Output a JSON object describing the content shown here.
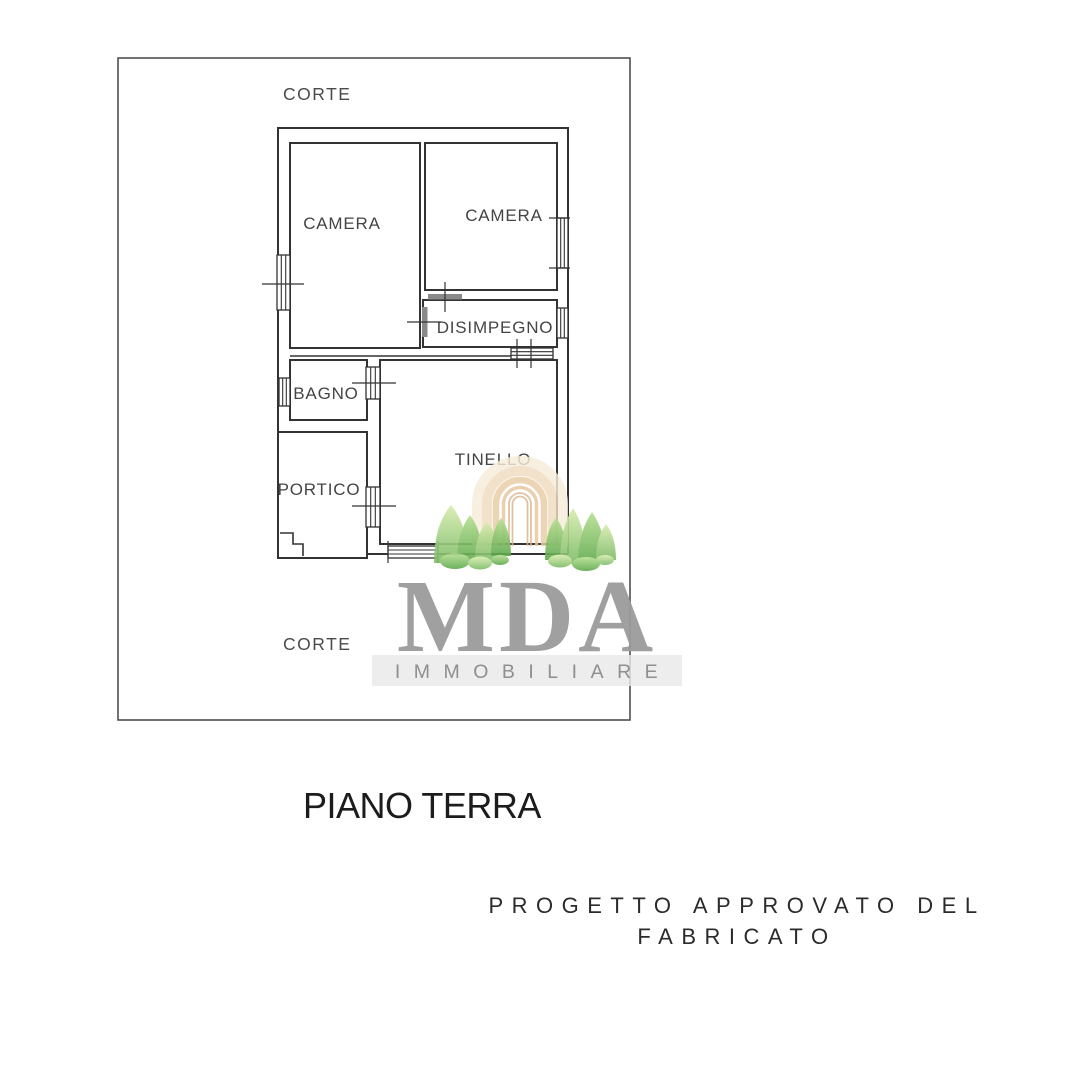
{
  "plan": {
    "court_top": "CORTE",
    "court_bottom": "CORTE",
    "rooms": [
      {
        "id": "camera-left",
        "label": "CAMERA"
      },
      {
        "id": "camera-right",
        "label": "CAMERA"
      },
      {
        "id": "disimpegno",
        "label": "DISIMPEGNO"
      },
      {
        "id": "bagno",
        "label": "BAGNO"
      },
      {
        "id": "portico",
        "label": "PORTICO"
      },
      {
        "id": "tinello",
        "label": "TINELLO"
      }
    ]
  },
  "captions": {
    "floor_title": "PIANO TERRA",
    "approval_line1": "PROGETTO APPROVATO DEL",
    "approval_line2": "FABRICATO"
  },
  "watermark": {
    "brand": "MDA",
    "subtitle": "IMMOBILIARE",
    "brand_color": "#9b9b9b",
    "subtitle_color": "#8f8f8f",
    "band_color": "#e9e9e9",
    "arch_color": "#e9cda4",
    "tree_green_light": "#d8edaf",
    "tree_green_dark": "#5ea94c"
  }
}
